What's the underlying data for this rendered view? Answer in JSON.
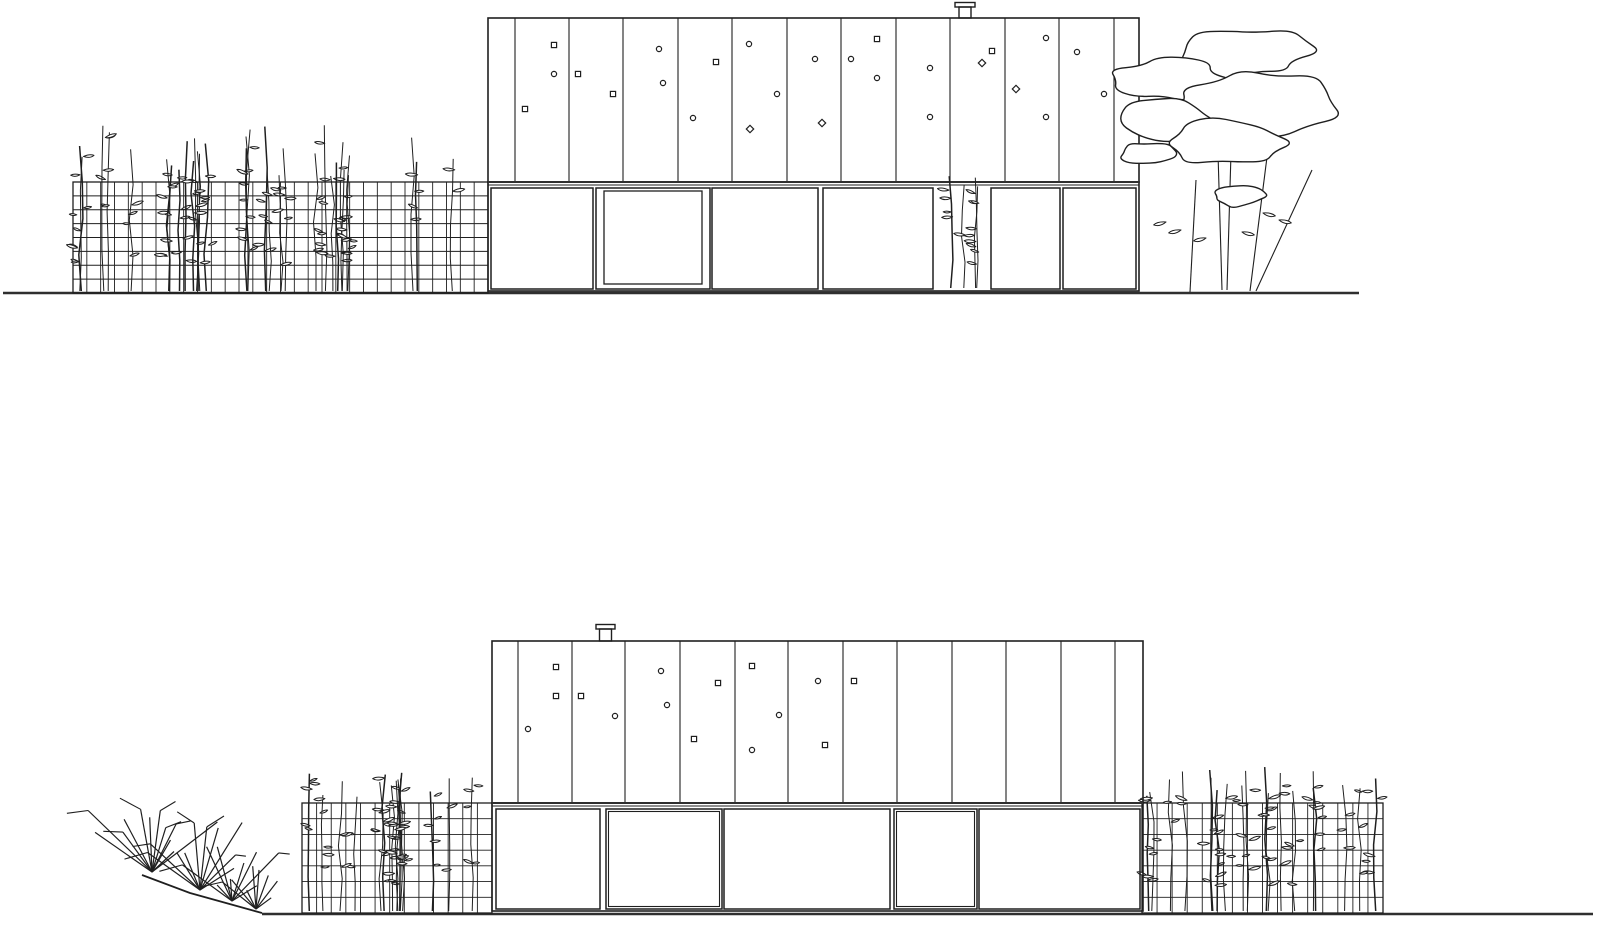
{
  "meta": {
    "title": "architectural-elevations-cad-drawing",
    "background": "#ffffff",
    "ink": "#1f1f1f",
    "heavy_ink": "#2f2f2f",
    "canvas": {
      "width": 1600,
      "height": 927
    }
  },
  "elevations": [
    {
      "id": "upper-elevation",
      "ground": {
        "x1": 3,
        "x2": 1359,
        "y": 293,
        "slope": null
      },
      "building": {
        "left": 488,
        "right": 1139,
        "top": 18,
        "split": 182,
        "bottom": 291,
        "panel_lines": [
          515,
          569,
          623,
          678,
          732,
          787,
          841,
          896,
          950,
          1005,
          1059,
          1114
        ],
        "chimney": {
          "cap_x": 955,
          "cap_w": 20,
          "cap_y": 2.5,
          "cap_h": 4.5,
          "body_x": 959,
          "body_w": 12
        },
        "lower_panels": [
          {
            "x1": 491,
            "x2": 593,
            "type": "plain"
          },
          {
            "x1": 596,
            "x2": 710,
            "type": "window"
          },
          {
            "x1": 712,
            "x2": 818,
            "type": "plain"
          },
          {
            "x1": 823,
            "x2": 933,
            "type": "plain"
          },
          {
            "x1": 936,
            "x2": 988,
            "type": "plant",
            "seed": 61
          },
          {
            "x1": 991,
            "x2": 1060,
            "type": "plain"
          },
          {
            "x1": 1063,
            "x2": 1136,
            "type": "plain"
          }
        ],
        "dots": [
          {
            "x": 525,
            "y": 109,
            "s": "s"
          },
          {
            "x": 554,
            "y": 45,
            "s": "s"
          },
          {
            "x": 554,
            "y": 74,
            "s": "c"
          },
          {
            "x": 578,
            "y": 74,
            "s": "s"
          },
          {
            "x": 613,
            "y": 94,
            "s": "s"
          },
          {
            "x": 659,
            "y": 49,
            "s": "c"
          },
          {
            "x": 663,
            "y": 83,
            "s": "c"
          },
          {
            "x": 693,
            "y": 118,
            "s": "c"
          },
          {
            "x": 716,
            "y": 62,
            "s": "s"
          },
          {
            "x": 749,
            "y": 44,
            "s": "c"
          },
          {
            "x": 750,
            "y": 129,
            "s": "d"
          },
          {
            "x": 777,
            "y": 94,
            "s": "c"
          },
          {
            "x": 815,
            "y": 59,
            "s": "c"
          },
          {
            "x": 822,
            "y": 123,
            "s": "d"
          },
          {
            "x": 851,
            "y": 59,
            "s": "c"
          },
          {
            "x": 877,
            "y": 39,
            "s": "s"
          },
          {
            "x": 877,
            "y": 78,
            "s": "c"
          },
          {
            "x": 930,
            "y": 68,
            "s": "c"
          },
          {
            "x": 930,
            "y": 117,
            "s": "c"
          },
          {
            "x": 982,
            "y": 63,
            "s": "d"
          },
          {
            "x": 992,
            "y": 51,
            "s": "s"
          },
          {
            "x": 1016,
            "y": 89,
            "s": "d"
          },
          {
            "x": 1046,
            "y": 38,
            "s": "c"
          },
          {
            "x": 1046,
            "y": 117,
            "s": "c"
          },
          {
            "x": 1077,
            "y": 52,
            "s": "c"
          },
          {
            "x": 1104,
            "y": 94,
            "s": "c"
          }
        ]
      },
      "gabions": [
        {
          "x": 73,
          "y": 182,
          "w": 415,
          "h": 111,
          "cell": 13.8,
          "seed": 11,
          "stems": 32,
          "rise": 52
        }
      ],
      "tree": {
        "blobs": [
          {
            "cx": 1243,
            "cy": 52,
            "rx": 72,
            "ry": 26,
            "seed": 3
          },
          {
            "cx": 1172,
            "cy": 80,
            "rx": 58,
            "ry": 21,
            "seed": 5
          },
          {
            "cx": 1260,
            "cy": 102,
            "rx": 88,
            "ry": 34,
            "seed": 8
          },
          {
            "cx": 1168,
            "cy": 124,
            "rx": 52,
            "ry": 24,
            "seed": 13
          },
          {
            "cx": 1228,
            "cy": 143,
            "rx": 62,
            "ry": 24,
            "seed": 17
          },
          {
            "cx": 1150,
            "cy": 153,
            "rx": 29,
            "ry": 11,
            "seed": 21
          },
          {
            "cx": 1240,
            "cy": 196,
            "rx": 30,
            "ry": 11,
            "seed": 27
          }
        ],
        "trunks": [
          [
            1196,
            180,
            1190,
            292
          ],
          [
            1218,
            153,
            1222,
            290
          ],
          [
            1231,
            153,
            1227,
            290
          ],
          [
            1267,
            157,
            1250,
            291
          ],
          [
            1312,
            170,
            1256,
            291
          ],
          [
            1243,
            88,
            1243,
            108
          ]
        ],
        "leaves": [
          [
            1166,
            222,
            -1
          ],
          [
            1181,
            230,
            -1
          ],
          [
            1228,
            197,
            1
          ],
          [
            1242,
            232,
            1
          ],
          [
            1263,
            213,
            1
          ],
          [
            1279,
            220,
            1
          ],
          [
            1206,
            238,
            -1
          ]
        ]
      },
      "grass": null
    },
    {
      "id": "lower-elevation",
      "ground": {
        "x1": 262,
        "x2": 1593,
        "y": 914,
        "slope": [
          [
            142,
            875
          ],
          [
            190,
            893
          ],
          [
            262,
            913
          ]
        ]
      },
      "building": {
        "left": 492,
        "right": 1143,
        "top": 641,
        "split": 803,
        "bottom": 911,
        "panel_lines": [
          518,
          572,
          625,
          680,
          735,
          788,
          843,
          897,
          952,
          1006,
          1061,
          1115
        ],
        "chimney": {
          "cap_x": 596,
          "cap_w": 19,
          "cap_y": 624.5,
          "cap_h": 4.5,
          "body_x": 599.5,
          "body_w": 12
        },
        "lower_panels": [
          {
            "x1": 496,
            "x2": 600,
            "type": "plain"
          },
          {
            "x1": 606,
            "x2": 722,
            "type": "double"
          },
          {
            "x1": 724,
            "x2": 890,
            "type": "plain"
          },
          {
            "x1": 894,
            "x2": 977,
            "type": "double"
          },
          {
            "x1": 979,
            "x2": 1140,
            "type": "plain"
          }
        ],
        "dots": [
          {
            "x": 556,
            "y": 667,
            "s": "s"
          },
          {
            "x": 556,
            "y": 696,
            "s": "s"
          },
          {
            "x": 581,
            "y": 696,
            "s": "s"
          },
          {
            "x": 615,
            "y": 716,
            "s": "c"
          },
          {
            "x": 528,
            "y": 729,
            "s": "c"
          },
          {
            "x": 661,
            "y": 671,
            "s": "c"
          },
          {
            "x": 667,
            "y": 705,
            "s": "c"
          },
          {
            "x": 718,
            "y": 683,
            "s": "s"
          },
          {
            "x": 694,
            "y": 739,
            "s": "s"
          },
          {
            "x": 752,
            "y": 666,
            "s": "s"
          },
          {
            "x": 779,
            "y": 715,
            "s": "c"
          },
          {
            "x": 752,
            "y": 750,
            "s": "c"
          },
          {
            "x": 818,
            "y": 681,
            "s": "c"
          },
          {
            "x": 825,
            "y": 745,
            "s": "s"
          },
          {
            "x": 854,
            "y": 681,
            "s": "s"
          }
        ]
      },
      "gabions": [
        {
          "x": 302,
          "y": 803,
          "w": 190,
          "h": 110,
          "cell": 15,
          "seed": 23,
          "stems": 15,
          "rise": 30
        },
        {
          "x": 1142,
          "y": 803,
          "w": 241,
          "h": 110,
          "cell": 15,
          "seed": 37,
          "stems": 19,
          "rise": 30
        }
      ],
      "tree": null,
      "grass": {
        "seed": 99,
        "clusters": [
          {
            "x": 152,
            "y": 872,
            "n": 12,
            "lmin": 30,
            "lmax": 95
          },
          {
            "x": 200,
            "y": 890,
            "n": 10,
            "lmin": 25,
            "lmax": 80
          },
          {
            "x": 232,
            "y": 901,
            "n": 9,
            "lmin": 20,
            "lmax": 70
          },
          {
            "x": 256,
            "y": 909,
            "n": 8,
            "lmin": 18,
            "lmax": 55
          }
        ]
      }
    }
  ]
}
